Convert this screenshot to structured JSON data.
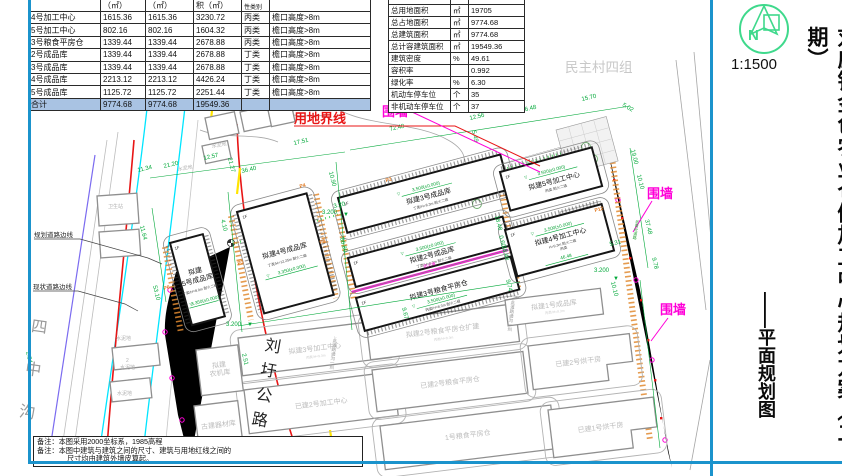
{
  "left_table": {
    "header": [
      "",
      "（㎡）",
      "（㎡）",
      "积（㎡）",
      "性类别",
      ""
    ],
    "rows": [
      [
        "4号加工中心",
        "1615.36",
        "1615.36",
        "3230.72",
        "丙类",
        "檐口高度>8m"
      ],
      [
        "5号加工中心",
        "802.16",
        "802.16",
        "1604.32",
        "丙类",
        "檐口高度>8m"
      ],
      [
        "3号粮食平房仓",
        "1339.44",
        "1339.44",
        "2678.88",
        "丙类",
        "檐口高度>8m"
      ],
      [
        "2号成品库",
        "1339.44",
        "1339.44",
        "2678.88",
        "丁类",
        "檐口高度>8m"
      ],
      [
        "3号成品库",
        "1339.44",
        "1339.44",
        "2678.88",
        "丁类",
        "檐口高度>8m"
      ],
      [
        "4号成品库",
        "2213.12",
        "2213.12",
        "4426.24",
        "丁类",
        "檐口高度>8m"
      ],
      [
        "5号成品库",
        "1125.72",
        "1125.72",
        "2251.44",
        "丁类",
        "檐口高度>8m"
      ],
      [
        "合计",
        "9774.68",
        "9774.68",
        "19549.36",
        "",
        ""
      ]
    ]
  },
  "indicator_table": {
    "rows": [
      [
        "总用地面积",
        "㎡",
        "19705"
      ],
      [
        "总占地面积",
        "㎡",
        "9774.68"
      ],
      [
        "总建筑面积",
        "㎡",
        "9774.68"
      ],
      [
        "总计容建筑面积",
        "㎡",
        "19549.36"
      ],
      [
        "建筑密度",
        "%",
        "49.61"
      ],
      [
        "容积率",
        "",
        "0.992"
      ],
      [
        "绿化率",
        "%",
        "6.30"
      ],
      [
        "机动车停车位",
        "个",
        "35"
      ],
      [
        "非机动车停车位",
        "个",
        "37"
      ]
    ]
  },
  "notes": {
    "line1": "备注：本图采用2000坐标系，1985高程",
    "line2": "备注：本图中建筑与建筑之间的尺寸、建筑与用地红线之间的",
    "line3": "尺寸均由建筑外墙皮算起。"
  },
  "panel": {
    "north_letter": "N",
    "scale": "1:1500",
    "title": "刘庄镇金色农业仓储加工中心规划方案（二期）",
    "subtitle": "——平面规划图"
  },
  "map": {
    "labels": {
      "land_boundary": "用地界线",
      "fence": "围墙",
      "firewall": "防火墙"
    },
    "roads": {
      "planned_edge": "规划道路边线",
      "existing_edge": "现状道路边线",
      "canal": "四中沟",
      "highway": "刘圩公路",
      "village": "民主村四组",
      "note": "↓此道路通沟一圳",
      "fence_road": "沥青砼道路"
    },
    "ground": {
      "cement": "水泥地",
      "clinic": "卫生站",
      "num2": "2"
    },
    "floor": "1F",
    "icons": {
      "open": "▽",
      "solid": "▼"
    },
    "buildings": {
      "cp5": {
        "name1": "拟建",
        "name2": "5号成品库",
        "sub": "丁类/H=8.9m 耐火二级",
        "elev": "3.350(±0.000)"
      },
      "cp4": {
        "name": "拟建4号成品库",
        "sub": "丁类/H=12.25m 耐火二级",
        "elev": "3.350(±0.000)"
      },
      "cp3": {
        "name": "拟建3号成品库",
        "sub": "丁类/H=8.3m 耐火二级",
        "elev": "3.500(±0.000)"
      },
      "cp2": {
        "name": "拟建2号成品库",
        "sub": "丁类/H=8.3m 耐火二级",
        "elev": "3.500(±0.000)"
      },
      "lc3": {
        "name": "拟建3号粮食平房仓",
        "sub": "丙类/H=8.3m 耐火二级",
        "elev": "3.500(±0.000)"
      },
      "jg5": {
        "name": "拟建5号加工中心",
        "sub": "丙类 耐火二级",
        "elev": "3.500(±0.000)"
      },
      "jg4": {
        "name": "拟建4号加工中心",
        "sub": "H=9.3m 耐火二级",
        "sub2": "丙类",
        "elev": "3.500(±0.000)",
        "dim": "46.48"
      }
    },
    "existing": {
      "jg3": "拟建3号加工中心",
      "jg3_sub": "丙类/H=9.3m",
      "jg2": "已建2号加工中心",
      "lk2": "拟建2号粮食平房仓扩建",
      "lk2_sub": "丙类/H=8.3m",
      "lj2": "已建2号粮食平房仓",
      "l1": "1号粮食平房仓",
      "cp1": "拟建1号成品库",
      "cp1_sub": "丙类/H=8.3m",
      "hg2": "已建2号烘干房",
      "hg1": "已建1号烘干房",
      "njk1": "拟建",
      "njk2": "农机库",
      "gjk": "古建器材库"
    },
    "parking": {
      "p2": "P2",
      "p3": "P3",
      "p4": "P4",
      "p6": "P6",
      "p9": "P9",
      "p12": "P12"
    },
    "marks": {
      "m1": "3.200",
      "m2": "3.200",
      "m3": "3.200"
    },
    "dims": {
      "d1": "72.48",
      "d2": "17.51",
      "d3": "36.40",
      "d4": "12.57",
      "d5": "21.20",
      "d6": "11.34",
      "d7": "10.90",
      "d8": "11.64",
      "d9": "53.10",
      "d10": "21.27",
      "d11": "4.10",
      "d12": "60.80",
      "d13": "3.20",
      "d14": "46.48",
      "d15": "12.56",
      "d16": "15.70",
      "d17": "5.02",
      "d18": "5.49",
      "d19": "19.00",
      "d20": "10.10",
      "d21": "37.48",
      "d22": "9.78",
      "d23": "18.48",
      "d24": "0.60",
      "d25": "18.48",
      "d26": "9.74",
      "d27": "9.67",
      "d28": "10.10",
      "d29": "2.84",
      "d30": "2.51",
      "d31": "5.31"
    }
  }
}
